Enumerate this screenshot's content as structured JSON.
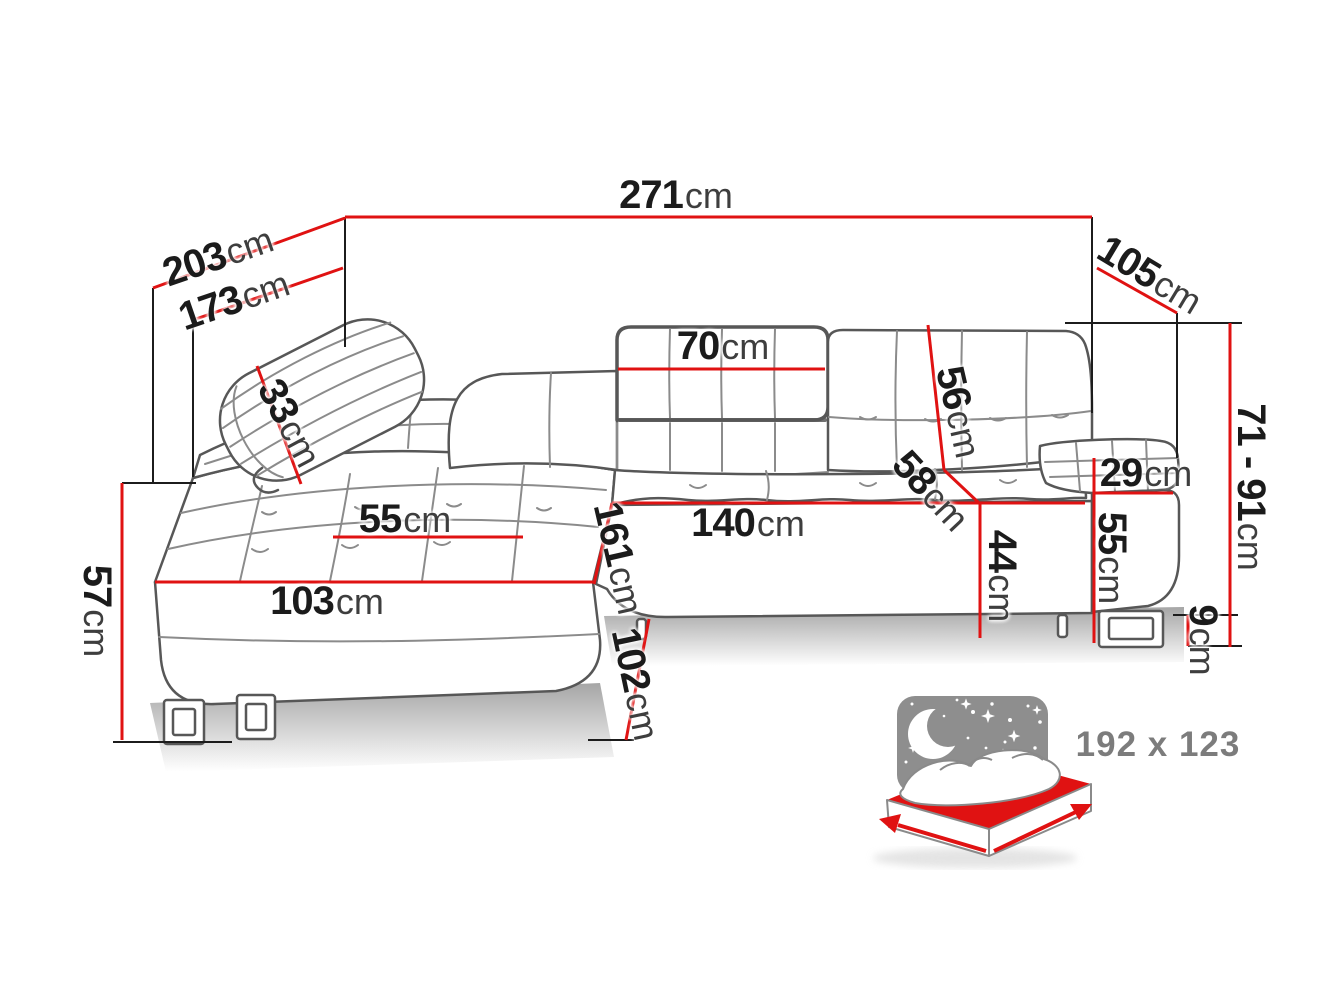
{
  "diagram": {
    "type": "corner-sofa dimension drawing",
    "unit_system": "cm"
  },
  "dims": {
    "d271": {
      "num": "271",
      "unit": "cm"
    },
    "d203": {
      "num": "203",
      "unit": "cm"
    },
    "d173": {
      "num": "173",
      "unit": "cm"
    },
    "d105": {
      "num": "105",
      "unit": "cm"
    },
    "d71_91": {
      "num": "71 - 91",
      "unit": "cm"
    },
    "d70": {
      "num": "70",
      "unit": "cm"
    },
    "d33": {
      "num": "33",
      "unit": "cm"
    },
    "d56": {
      "num": "56",
      "unit": "cm"
    },
    "d58": {
      "num": "58",
      "unit": "cm"
    },
    "d140": {
      "num": "140",
      "unit": "cm"
    },
    "d44": {
      "num": "44",
      "unit": "cm"
    },
    "d161": {
      "num": "161",
      "unit": "cm"
    },
    "d102": {
      "num": "102",
      "unit": "cm"
    },
    "d103": {
      "num": "103",
      "unit": "cm"
    },
    "d55_seat": {
      "num": "55",
      "unit": "cm"
    },
    "d57": {
      "num": "57",
      "unit": "cm"
    },
    "d55_arm": {
      "num": "55",
      "unit": "cm"
    },
    "d29": {
      "num": "29",
      "unit": "cm"
    },
    "d9": {
      "num": "9",
      "unit": "cm"
    },
    "sleep_area": {
      "label": "192 x 123"
    }
  },
  "colors": {
    "dimension_red": "#e01212",
    "sofa_line_grey": "#575757",
    "icon_grey": "#8e8e8e",
    "text_black": "#1b1b1b"
  }
}
